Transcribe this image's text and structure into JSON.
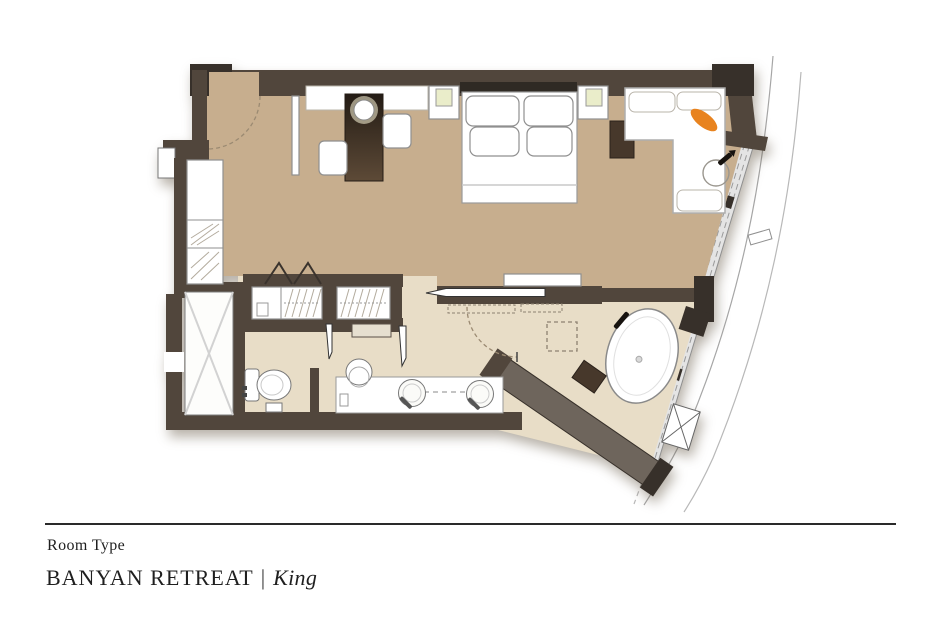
{
  "caption": {
    "room_type_label": "Room Type",
    "room_name": "BANYAN RETREAT",
    "separator": "|",
    "room_variant": "King"
  },
  "colors": {
    "background": "#ffffff",
    "wall-mid": "#51463c",
    "wall-dark": "#37302a",
    "wall-light": "#6e655c",
    "floor-bedroom": "#c7ae8e",
    "floor-bathroom": "#e8ddc7",
    "furniture-white": "#ffffff",
    "outline-gray": "#8f8f8f",
    "wood-mid": "#47382b",
    "wood-dark": "#2b221b",
    "accent-orange": "#e8831f",
    "lamp-glow": "#eaedca",
    "arc-dash": "#9b8a72",
    "glazing": "#e4e4e4",
    "facade-line": "#a6a6a6",
    "rule": "#2a2a2a",
    "text": "#1f1f1f"
  }
}
